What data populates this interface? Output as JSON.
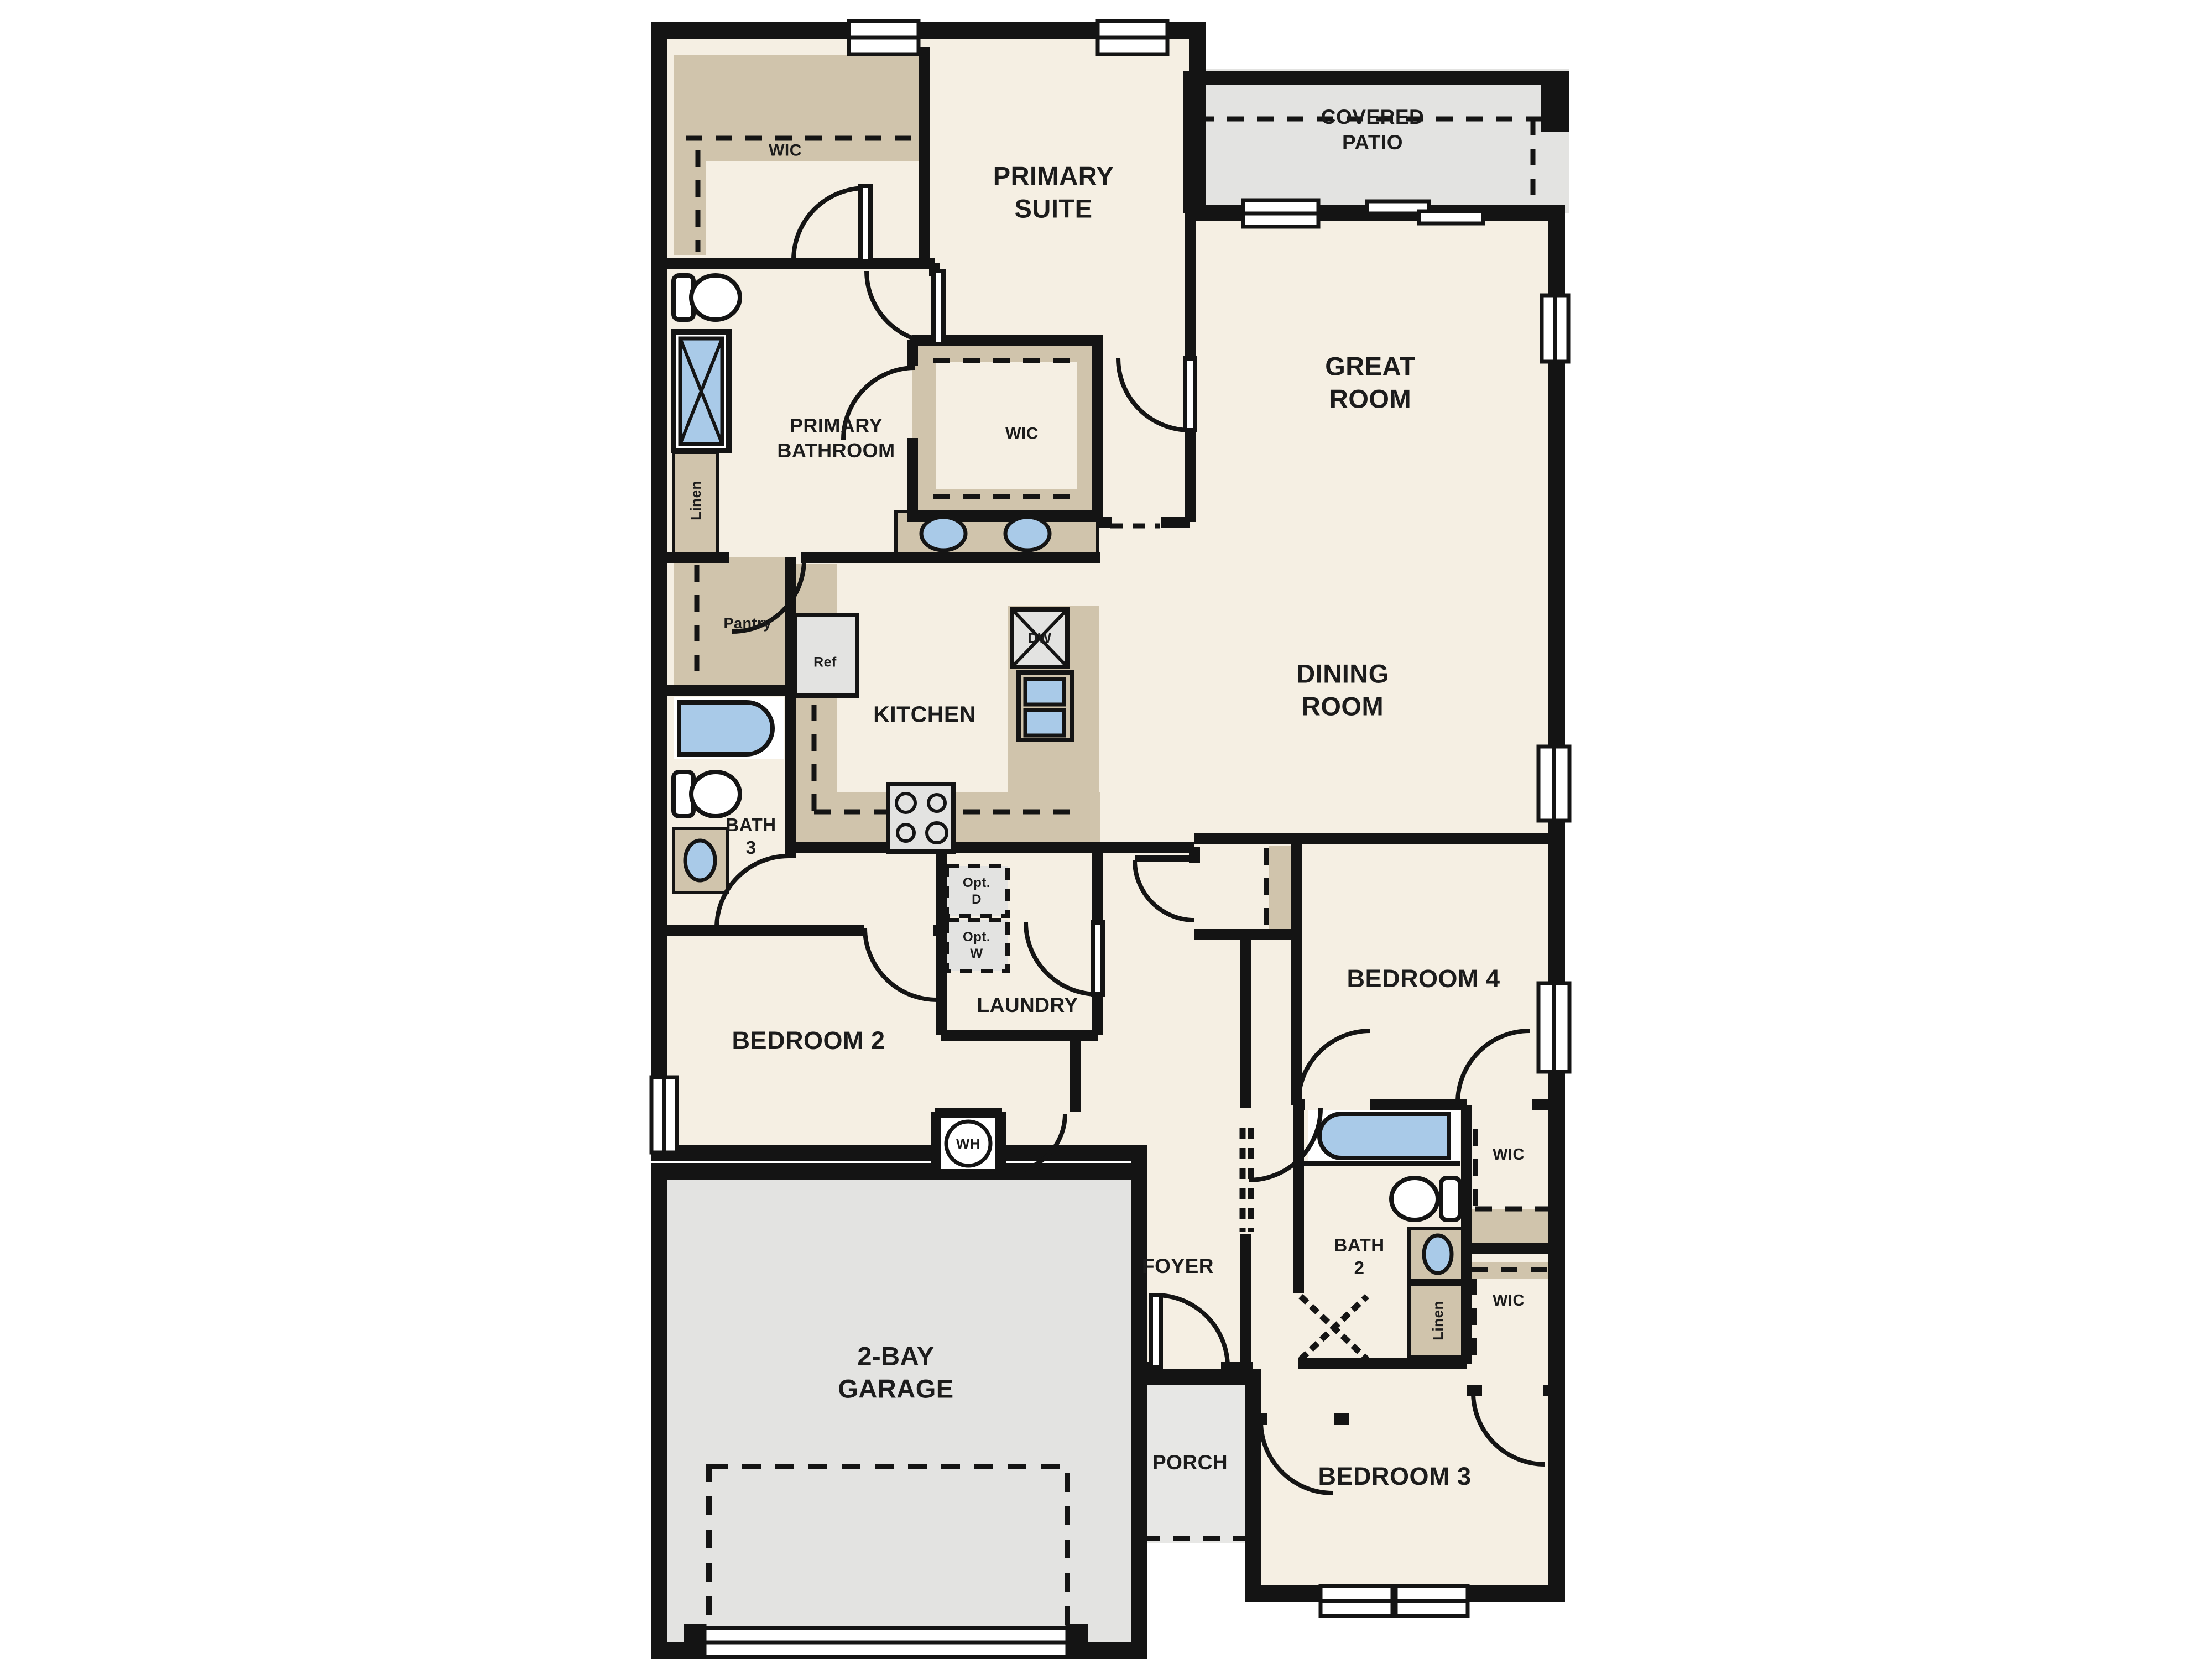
{
  "plan": {
    "type": "single-story residential floor plan",
    "colors": {
      "wall": "#141414",
      "floor_beige": "#f5efe3",
      "cabinet_tan": "#d0c4ac",
      "concrete_gray": "#e3e3e1",
      "porch_gray": "#e7e7e5",
      "fixture_blue": "#a9cae8",
      "background": "#ffffff"
    },
    "labels": {
      "wic_primary": "WIC",
      "primary_suite": "PRIMARY\nSUITE",
      "covered_patio": "COVERED\nPATIO",
      "great_room": "GREAT\nROOM",
      "primary_bathroom": "PRIMARY\nBATHROOM",
      "wic_primary_2": "WIC",
      "linen_primary": "Linen",
      "pantry": "Pantry",
      "ref": "Ref",
      "dw": "DW",
      "kitchen": "KITCHEN",
      "dining_room": "DINING\nROOM",
      "bath_3": "BATH\n3",
      "opt_d": "Opt.\nD",
      "opt_w": "Opt.\nW",
      "laundry": "LAUNDRY",
      "bedroom_2": "BEDROOM 2",
      "bedroom_4": "BEDROOM 4",
      "wh": "WH",
      "wic_bed4": "WIC",
      "bath_2": "BATH\n2",
      "linen_2": "Linen",
      "wic_bed3": "WIC",
      "foyer": "FOYER",
      "garage": "2-BAY\nGARAGE",
      "porch": "PORCH",
      "bedroom_3": "BEDROOM 3"
    }
  }
}
